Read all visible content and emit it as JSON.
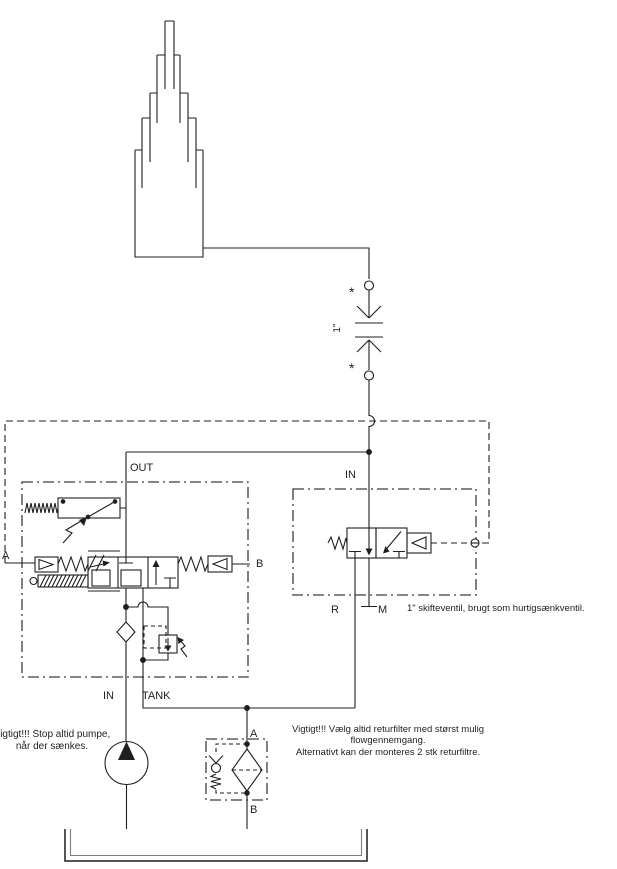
{
  "ports": {
    "out": "OUT",
    "in_main": "IN",
    "tank": "TANK",
    "a": "A",
    "b": "B",
    "in_shuttle": "IN",
    "r": "R",
    "m": "M",
    "filter_a": "A",
    "filter_b": "B"
  },
  "coupling": {
    "star_top": "*",
    "star_bottom": "*",
    "size": "1\""
  },
  "notes": {
    "pump_line1": "Vigtigt!!! Stop altid pumpe,",
    "pump_line2": "når der sænkes.",
    "shuttle": "1\" skifteventil, brugt som hurtigsænkventil.",
    "filter_line1": "Vigtigt!!! Vælg altid returfilter med størst mulig",
    "filter_line2": "flowgennemgang.",
    "filter_line3": "Alternativt kan der monteres 2 stk returfiltre."
  },
  "colors": {
    "line": "#1f1f1f",
    "background": "#ffffff"
  }
}
